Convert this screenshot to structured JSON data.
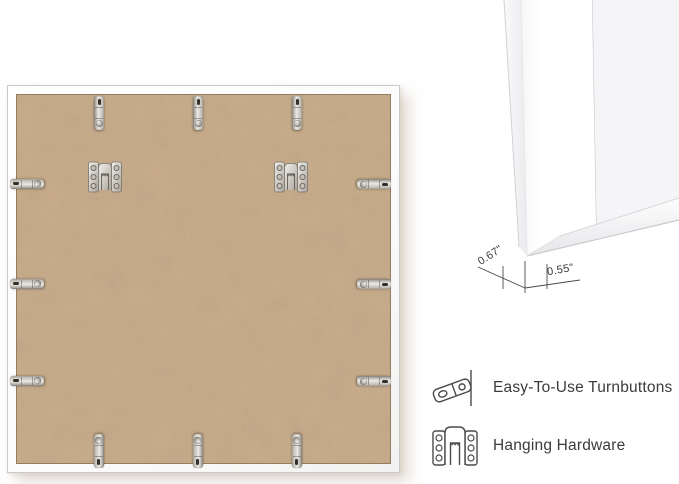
{
  "corner_detail": {
    "depth_label": "0.67\"",
    "face_width_label": "0.55\""
  },
  "features": [
    {
      "icon": "turnbutton-icon",
      "label": "Easy-To-Use Turnbuttons"
    },
    {
      "icon": "hanging-hardware-icon",
      "label": "Hanging Hardware"
    }
  ],
  "hardware": {
    "turnbutton_count": 12,
    "hanging_hardware_count": 2
  },
  "colors": {
    "background": "#ffffff",
    "backing_tan": "#c9ac8b",
    "metal_silver": "#d6d2cb",
    "mat_gray": "#f5f5f7",
    "text": "#3b3b3b"
  }
}
